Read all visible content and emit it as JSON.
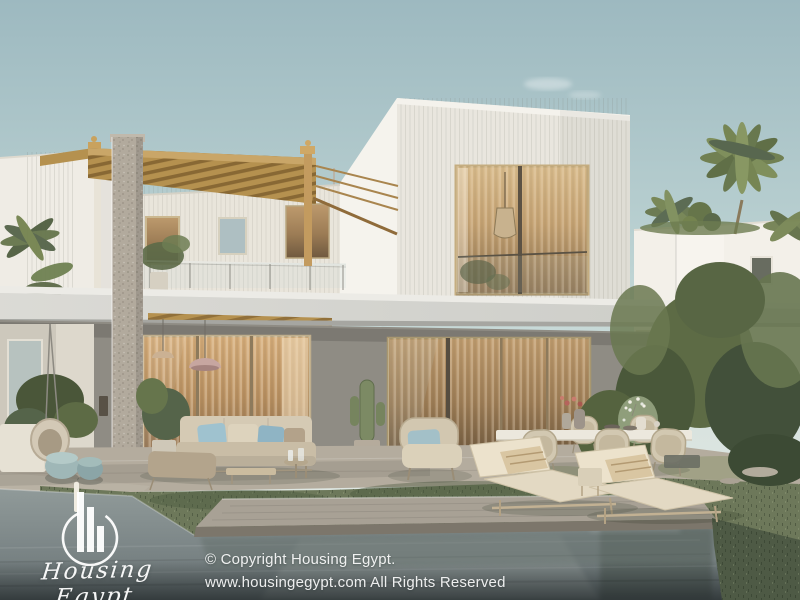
{
  "scene": {
    "kind": "exterior architectural render",
    "subject": "Two-storey modern white villa with wooden pergola terrace, stone-clad pillar, wide roof canopy, glass sliding doors, outdoor lounge sofa, dining set, two sun loungers, lawn and swimming pool",
    "vegetation": [
      "palm trees",
      "shrubs",
      "potted plants"
    ],
    "sky": "clear hazy blue daylight"
  },
  "watermark": {
    "brand": "Housing Egypt",
    "logo_icon": "circle-skyline-bars"
  },
  "copyright": {
    "line1": "© Copyright Housing Egypt.",
    "line2": "www.housingegypt.com All Rights Reserved"
  },
  "palette": {
    "sky_top": "#9db9c0",
    "sky_low": "#e7ebe6",
    "wall_white": "#f5f3ed",
    "wall_ribbed": "#e9e6de",
    "wall_shade": "#8f8c84",
    "canopy": "#d2d2cd",
    "pergola_wood": "#b5914f",
    "stone": "#b2aa9d",
    "glass_warm": "#b08a5c",
    "cushion_blue": "#a9c3c9",
    "grass": "#6d785a",
    "patio": "#b4ac9e",
    "pool": "#7e8889",
    "watermark_white": "#ffffff"
  }
}
